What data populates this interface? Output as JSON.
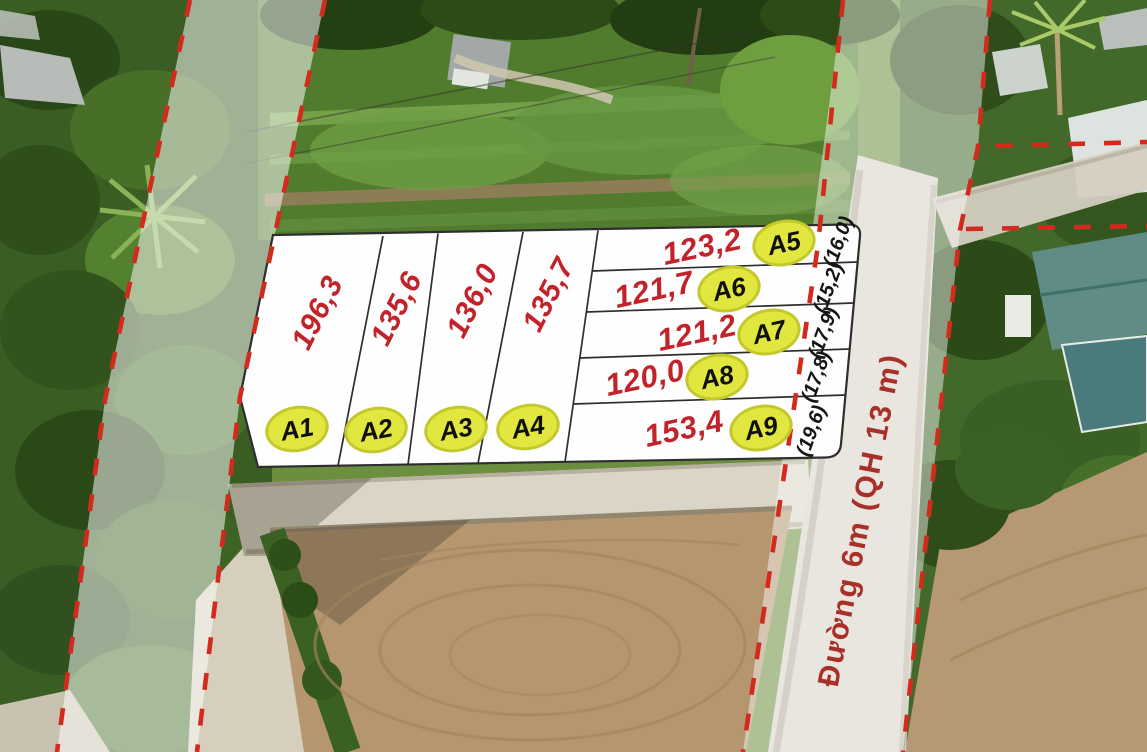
{
  "road": {
    "name_label": "Đường 6m (QH 13 m)"
  },
  "plots": {
    "columns": [
      {
        "id": "A1",
        "area": "196,3"
      },
      {
        "id": "A2",
        "area": "135,6"
      },
      {
        "id": "A3",
        "area": "136,0"
      },
      {
        "id": "A4",
        "area": "135,7"
      }
    ],
    "rows": [
      {
        "id": "A5",
        "area": "123,2",
        "frontage": "(16,0)"
      },
      {
        "id": "A6",
        "area": "121,7",
        "frontage": "(15,2)"
      },
      {
        "id": "A7",
        "area": "121,2",
        "frontage": "(17,9)"
      },
      {
        "id": "A8",
        "area": "120,0",
        "frontage": "(17,8)"
      },
      {
        "id": "A9",
        "area": "153,4",
        "frontage": "(19,6)"
      }
    ]
  },
  "colors": {
    "boundary_dash_red": "#d22b1e",
    "area_text_red": "#c2232b",
    "badge_yellow": "#e1e73e",
    "road_label_red": "#a93029",
    "plot_fill_white": "#fefefe"
  }
}
